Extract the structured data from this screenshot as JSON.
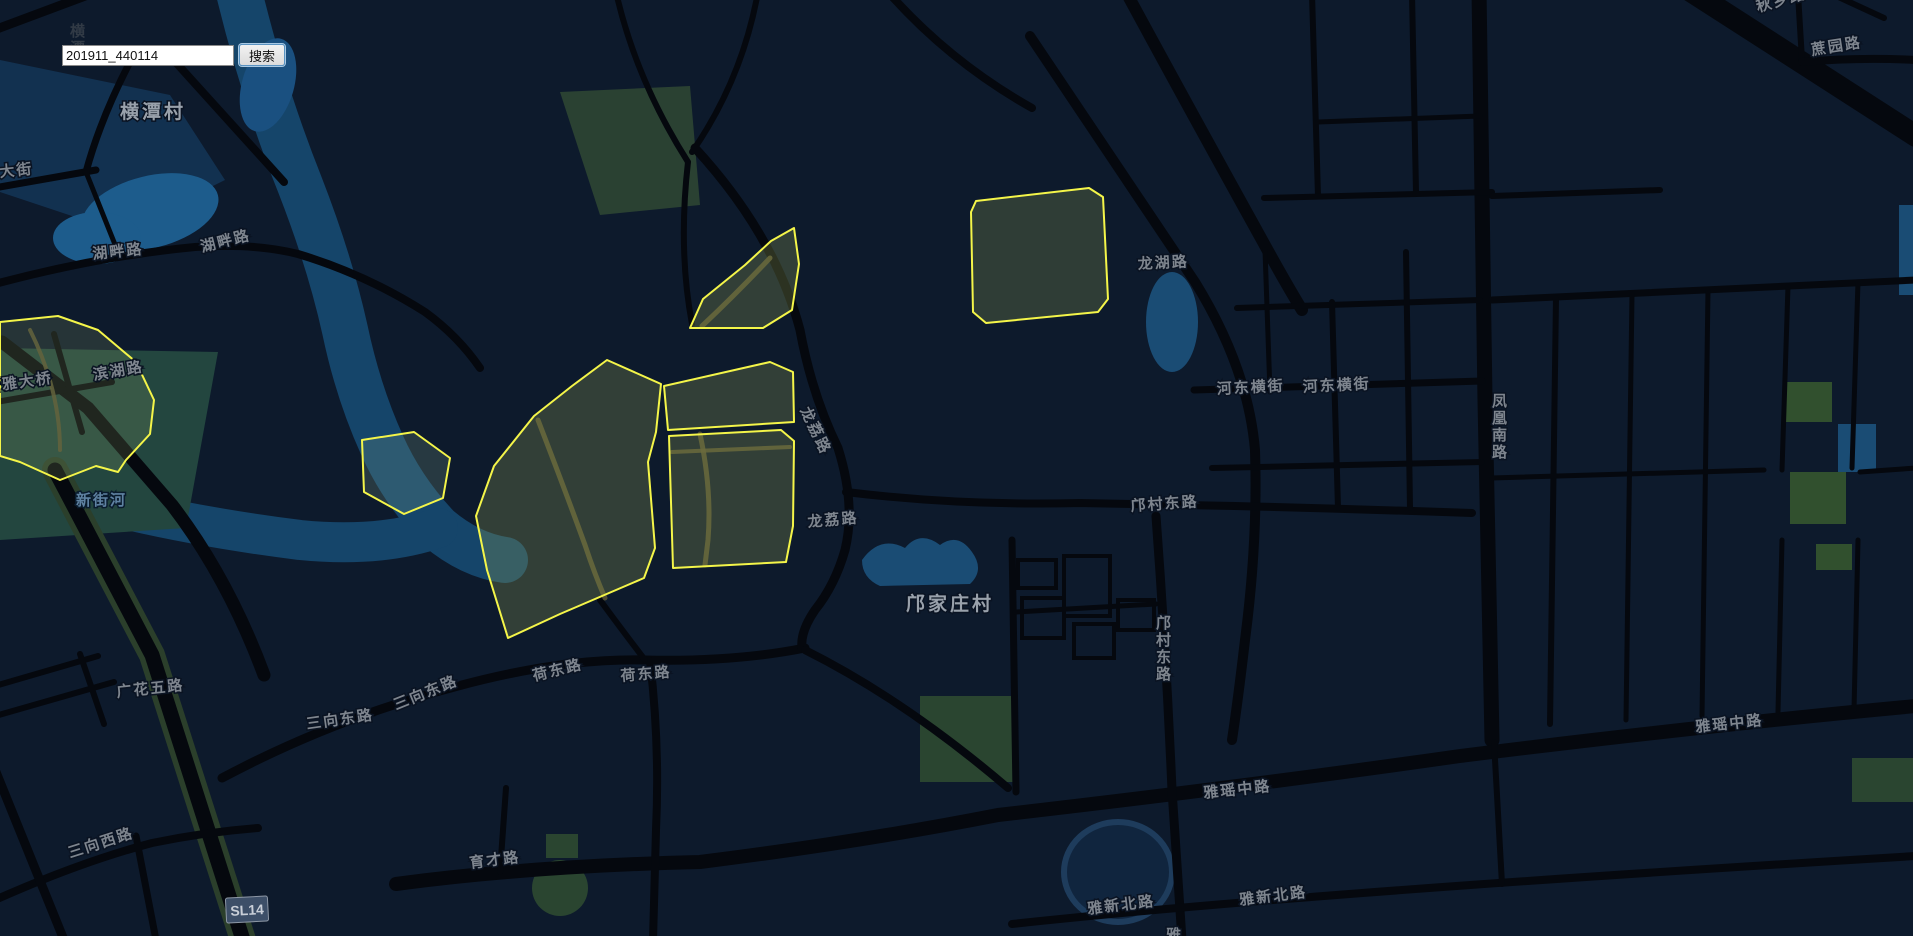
{
  "search": {
    "value": "201911_440114",
    "button_label": "搜索"
  },
  "map": {
    "highway_badge": {
      "text": "SL14",
      "x": 226,
      "y": 897,
      "rotate": -3,
      "w": 42,
      "h": 25
    },
    "colors": {
      "background": "#0d1a2c",
      "road": "#05080e",
      "water": "#15456a",
      "water_bright": "#1d5c8c",
      "teal_zone": "#23463f",
      "park": "#2a4530",
      "park_bright": "#31502e",
      "parcel_outline": "#f4f549",
      "label": "#7e858e",
      "village_label": "#99a1ab",
      "water_label": "#5f82a2",
      "highway_casing": "#2b3f2b",
      "badge_bg": "#3d4f68"
    },
    "labels": [
      {
        "text": "横潭村",
        "x": 120,
        "y": 118,
        "rotate": 0,
        "type": "village"
      },
      {
        "text": "湖畔路",
        "x": 93,
        "y": 259,
        "rotate": -6,
        "type": "road"
      },
      {
        "text": "湖畔路",
        "x": 202,
        "y": 252,
        "rotate": -14,
        "type": "road"
      },
      {
        "text": "滨湖路",
        "x": 94,
        "y": 380,
        "rotate": -10,
        "type": "road"
      },
      {
        "text": "新雅大桥",
        "x": -14,
        "y": 392,
        "rotate": -8,
        "type": "road"
      },
      {
        "text": "大街",
        "x": 0,
        "y": 177,
        "rotate": -6,
        "type": "road"
      },
      {
        "text": "新街河",
        "x": 76,
        "y": 505,
        "rotate": 0,
        "type": "water"
      },
      {
        "text": "广花五路",
        "x": 117,
        "y": 697,
        "rotate": -6,
        "type": "road"
      },
      {
        "text": "三向东路",
        "x": 396,
        "y": 710,
        "rotate": -22,
        "type": "road"
      },
      {
        "text": "三向东路",
        "x": 307,
        "y": 729,
        "rotate": -8,
        "type": "road"
      },
      {
        "text": "三向西路",
        "x": 70,
        "y": 858,
        "rotate": -18,
        "type": "road"
      },
      {
        "text": "荷东路",
        "x": 534,
        "y": 681,
        "rotate": -14,
        "type": "road"
      },
      {
        "text": "荷东路",
        "x": 621,
        "y": 681,
        "rotate": -5,
        "type": "road"
      },
      {
        "text": "育才路",
        "x": 470,
        "y": 868,
        "rotate": -7,
        "type": "road"
      },
      {
        "text": "龙荔路",
        "x": 808,
        "y": 527,
        "rotate": -5,
        "type": "road"
      },
      {
        "text": "龙荔路",
        "x": 800,
        "y": 410,
        "rotate": 64,
        "type": "road"
      },
      {
        "text": "邝家庄村",
        "x": 906,
        "y": 610,
        "rotate": 0,
        "type": "village"
      },
      {
        "text": "邝村东路",
        "x": 1131,
        "y": 511,
        "rotate": -4,
        "type": "road"
      },
      {
        "text": "邝村东路",
        "x": 1156,
        "y": 628,
        "vertical": true,
        "type": "road"
      },
      {
        "text": "龙湖路",
        "x": 1138,
        "y": 269,
        "rotate": -3,
        "type": "road"
      },
      {
        "text": "河东横街",
        "x": 1217,
        "y": 394,
        "rotate": -3,
        "type": "road"
      },
      {
        "text": "河东横街",
        "x": 1303,
        "y": 392,
        "rotate": -3,
        "type": "road"
      },
      {
        "text": "凤凰南路",
        "x": 1492,
        "y": 406,
        "vertical": true,
        "type": "road"
      },
      {
        "text": "雅瑶中路",
        "x": 1204,
        "y": 798,
        "rotate": -6,
        "type": "road"
      },
      {
        "text": "雅瑶中路",
        "x": 1696,
        "y": 732,
        "rotate": -6,
        "type": "road"
      },
      {
        "text": "雅新北路",
        "x": 1088,
        "y": 914,
        "rotate": -7,
        "type": "road"
      },
      {
        "text": "雅新北路",
        "x": 1240,
        "y": 905,
        "rotate": -7,
        "type": "road"
      },
      {
        "text": "雅",
        "x": 1166,
        "y": 940,
        "rotate": 0,
        "type": "road"
      },
      {
        "text": "秋乡路",
        "x": 1758,
        "y": 12,
        "rotate": -16,
        "type": "road"
      },
      {
        "text": "蔗园路",
        "x": 1812,
        "y": 55,
        "rotate": -9,
        "type": "road"
      },
      {
        "text": "横潭",
        "x": 70,
        "y": 36,
        "vertical": true,
        "type": "faint"
      }
    ],
    "parcels": [
      {
        "points": "0,322 58,316 98,330 136,362 154,400 150,434 126,460 118,472 96,466 60,480 20,462 0,456",
        "fill": "rgba(140,160,100,0.20)"
      },
      {
        "points": "362,440 414,432 450,458 443,498 404,514 364,492",
        "fill": "rgba(130,170,140,0.22)"
      },
      {
        "points": "607,360 661,384 656,432 648,462 655,548 644,578 560,614 508,638 487,570 476,516 494,466 534,416 572,386",
        "fill": "rgba(152,166,84,0.27)"
      },
      {
        "points": "664,386 770,362 793,372 794,422 668,430",
        "fill": "rgba(152,166,84,0.27)"
      },
      {
        "points": "794,228 799,264 792,310 763,328 690,328 703,299 745,265 771,241",
        "fill": "rgba(152,166,84,0.27)"
      },
      {
        "points": "669,436 781,430 794,441 793,526 786,562 673,568",
        "fill": "rgba(152,166,84,0.27)"
      },
      {
        "points": "976,201 1089,188 1103,197 1108,299 1098,312 986,323 973,312 971,212",
        "fill": "rgba(152,166,84,0.25)"
      }
    ]
  }
}
